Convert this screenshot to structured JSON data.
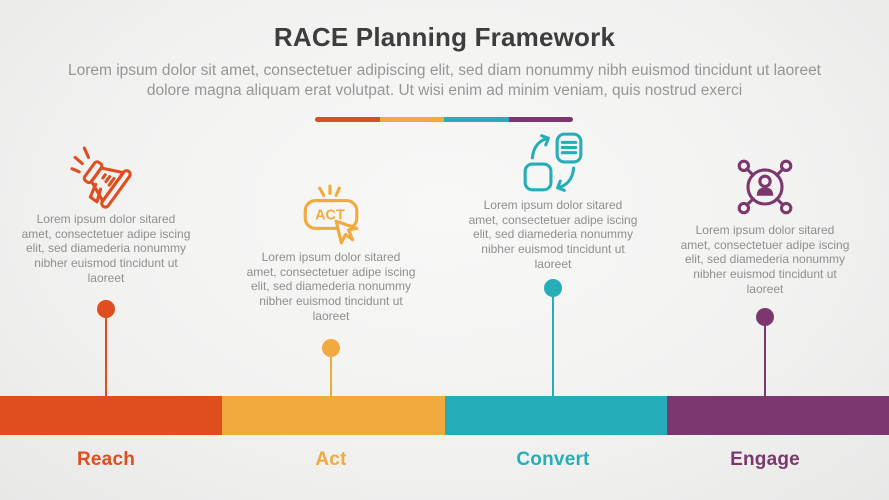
{
  "title": "RACE Planning Framework",
  "subtitle": "Lorem ipsum dolor sit amet, consectetuer adipiscing elit, sed diam nonummy nibh euismod tincidunt ut laoreet dolore magna aliquam erat volutpat. Ut wisi enim ad minim veniam, quis nostrud exerci",
  "divider_colors": [
    "#E04E20",
    "#F2A93D",
    "#25AEBA",
    "#7C386E"
  ],
  "stages": [
    {
      "letter": "R",
      "label": "Reach",
      "color": "#E04E20",
      "icon": "megaphone-icon",
      "description": "Lorem ipsum dolor sitared amet, consectetuer adipe iscing elit, sed diamederia nonummy nibher euismod tincidunt ut laoreet"
    },
    {
      "letter": "A",
      "label": "Act",
      "color": "#F2A93D",
      "icon": "act-button-cursor-icon",
      "icon_text": "ACT",
      "description": "Lorem ipsum dolor sitared amet, consectetuer adipe iscing elit, sed diamederia nonummy nibher euismod tincidunt ut laoreet"
    },
    {
      "letter": "C",
      "label": "Convert",
      "color": "#25AEBA",
      "icon": "exchange-documents-icon",
      "description": "Lorem ipsum dolor sitared amet, consectetuer adipe iscing elit, sed diamederia nonummy nibher euismod tincidunt ut laoreet"
    },
    {
      "letter": "E",
      "label": "Engage",
      "color": "#7C386E",
      "icon": "person-network-icon",
      "description": "Lorem ipsum dolor sitared amet, consectetuer adipe iscing elit, sed diamederia nonummy nibher euismod tincidunt ut laoreet"
    }
  ]
}
